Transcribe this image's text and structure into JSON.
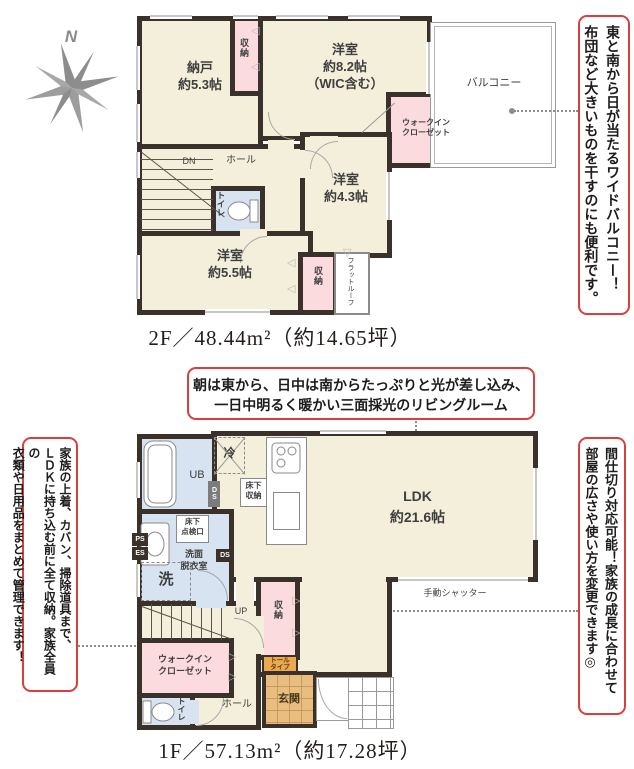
{
  "compass": {
    "n": "N"
  },
  "captions": {
    "floor2": "2F／48.44m²（約14.65坪）",
    "floor1": "1F／57.13m²（約17.28坪）"
  },
  "notes": {
    "balcony": {
      "l1": "東と南から日が当たるワイドバルコニー！",
      "l2": "布団など大きいものを干すのにも便利です。"
    },
    "living": {
      "l1": "朝は東から、日中は南からたっぷりと光が差し込み、",
      "l2": "一日中明るく暖かい三面採光のリビングルーム"
    },
    "storage": {
      "l1": "家族の上着、カバン、掃除道具まで、",
      "l2": "ＬＤＫに持ち込む前に全て収納。家族全員の",
      "l3": "衣類や日用品をまとめて管理できます！"
    },
    "partition": {
      "l1": "間仕切り対応可能！家族の成長に合わせて",
      "l2": "部屋の広さや使い方を変更できます◎"
    }
  },
  "floor2": {
    "nando": "納戸\n約5.3帖",
    "closet_n": "収納",
    "room82": "洋室\n約8.2帖\n（WIC含む）",
    "wic": "ウォークイン\nクローゼット",
    "balcony": "バルコニー",
    "room43": "洋室\n約4.3帖",
    "dn": "DN",
    "hall": "ホール",
    "toilet": "トイレ",
    "room55": "洋室\n約5.5帖",
    "closet_s": "収納",
    "flat_roof": "フラットルーフ"
  },
  "floor1": {
    "ub": "UB",
    "rei": "冷",
    "floor_storage": "床下\n収納",
    "ldk": "LDK\n約21.6帖",
    "inspection": "床下\n点検口",
    "washroom": "洗面\n脱衣室",
    "washer": "洗",
    "ps": "PS",
    "es": "ES",
    "ds1": "DS",
    "ds2": "DS",
    "up": "UP",
    "storage": "収納",
    "shutter": "手動シャッター",
    "wic": "ウォークイン\nクローゼット",
    "tall": "トール\nタイプ",
    "genkan": "玄関",
    "hall": "ホール",
    "toilet": "トイレ"
  }
}
